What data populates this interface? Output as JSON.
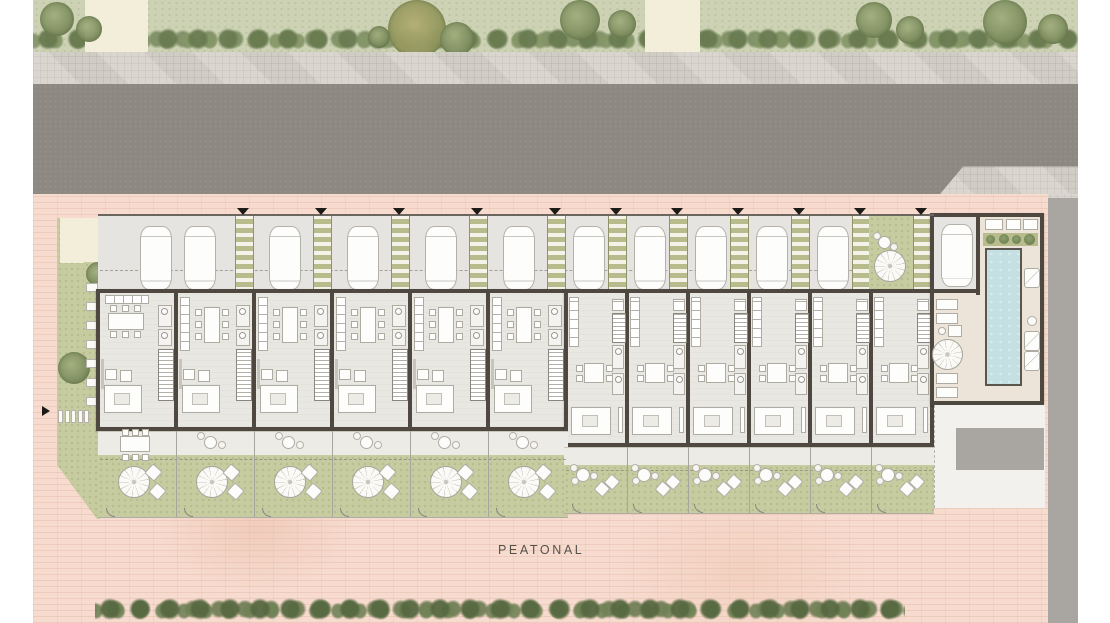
{
  "labels": {
    "pedestrian_street": "PEATONAL"
  },
  "site": {
    "townhouse_count": 12,
    "type_a_units": 6,
    "type_b_units": 6,
    "parking_spaces": 12,
    "entry_walkways": 11,
    "shared_amenities": [
      "pool-court",
      "entry-courtyard",
      "west-garden"
    ]
  },
  "colors": {
    "lawn": "#ccd2b3",
    "hedge": "#7e8e63",
    "path": "#f3eeda",
    "sidewalk": "#d8d4cc",
    "road": "#8d8882",
    "paving_pink": "#f6dbce",
    "floor": "#e9e7e2",
    "wall": "#4e4840",
    "walkway_olive": "#b8bc8c",
    "garden": "#c6cc9f",
    "terrace": "#edebe6",
    "pool": "#c5e0e2",
    "pool_deck": "#ece4d8",
    "gray_band": "#a9a5a1"
  }
}
